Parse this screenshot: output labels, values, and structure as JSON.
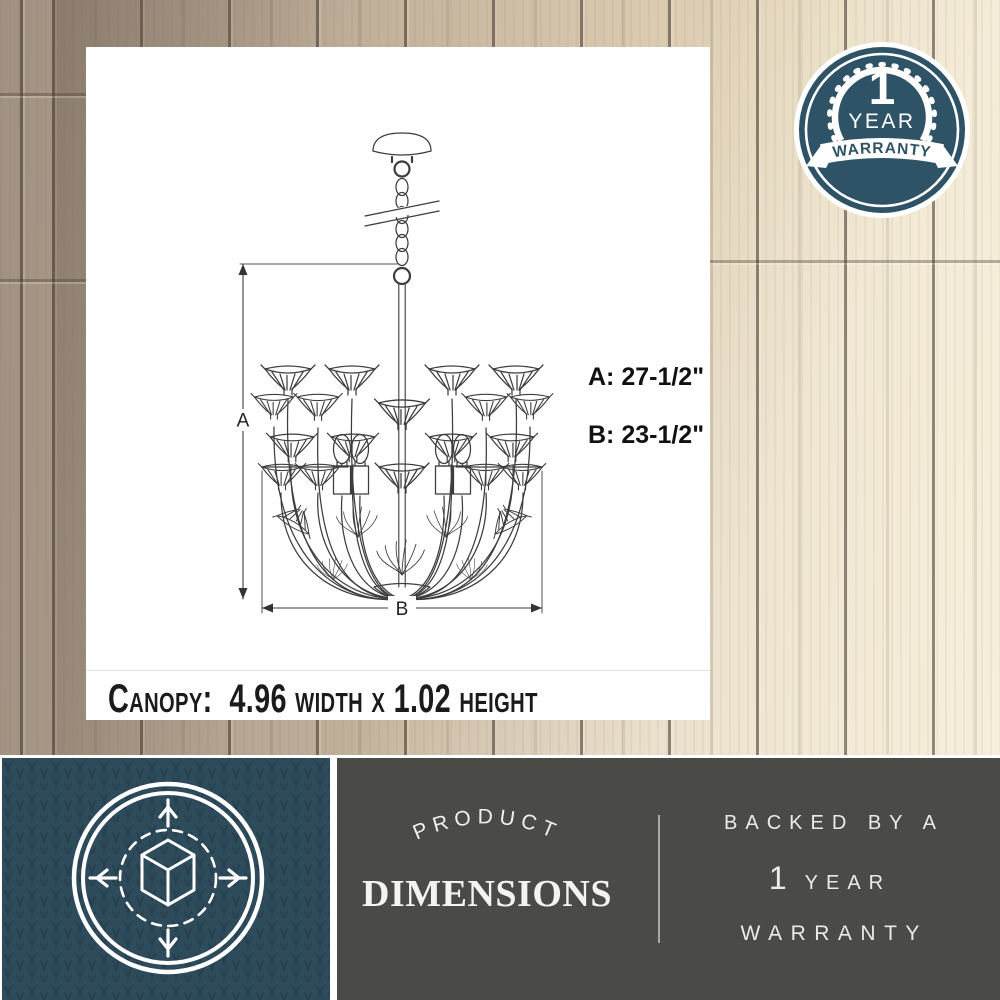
{
  "dimension_card": {
    "canopy_line": "Canopy:  4.96 width x 1.02 height",
    "dim_a": "A: 27-1/2\"",
    "dim_b": "B: 23-1/2\"",
    "marker_a": "A",
    "marker_b": "B"
  },
  "warranty_badge": {
    "number": "1",
    "year": "YEAR",
    "ribbon": "WARRANTY",
    "badge_color": "#2f5366"
  },
  "footer": {
    "tile_color": "#2e4b5b",
    "panel_color": "#4a4a47",
    "arch_word": "PRODUCT",
    "title": "DIMENSIONS",
    "right_line1": "BACKED BY A",
    "right_number": "1",
    "right_year": "YEAR",
    "right_line3": "WARRANTY"
  }
}
